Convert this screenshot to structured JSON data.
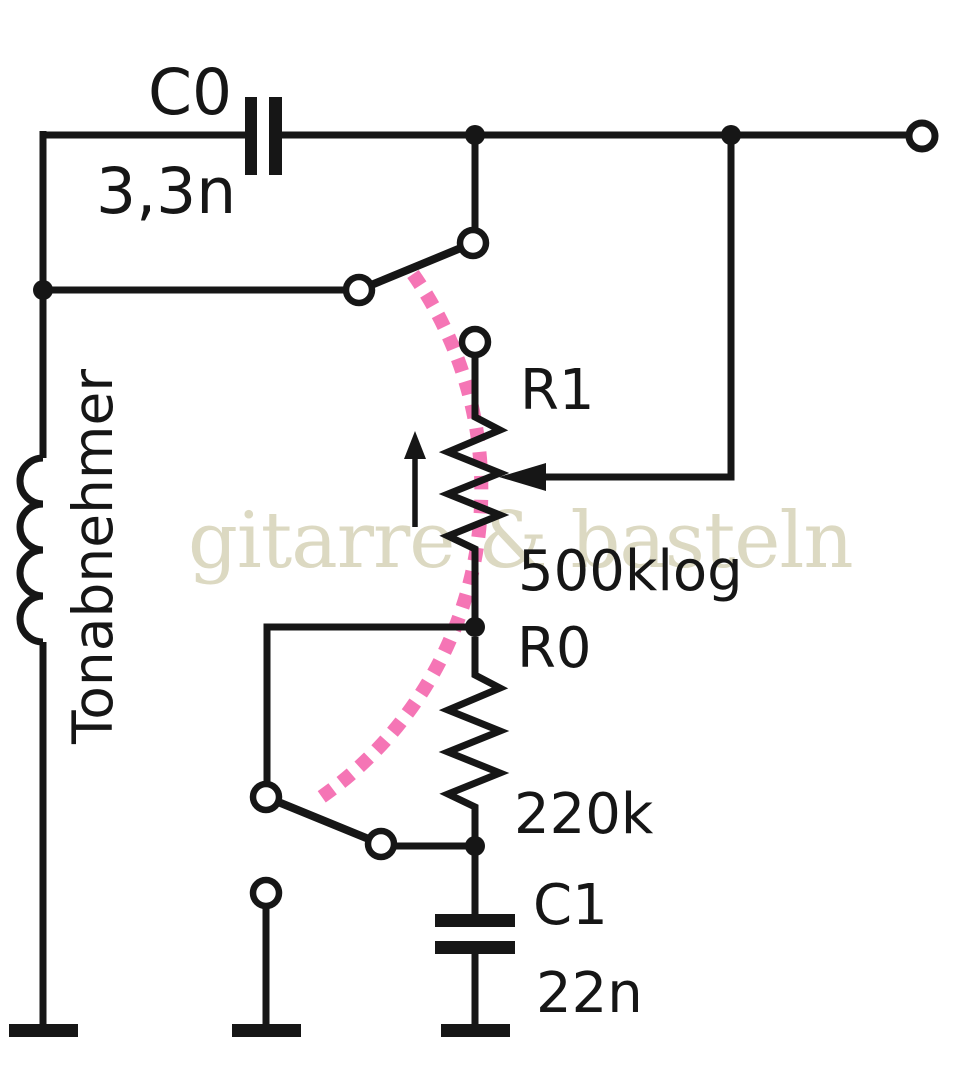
{
  "schematic": {
    "watermark": "gitarre & basteln",
    "pickup_label": "Tonabnehmer",
    "components": {
      "c0": {
        "ref": "C0",
        "value": "3,3n"
      },
      "r1": {
        "ref": "R1",
        "value": "500klog"
      },
      "r0": {
        "ref": "R0",
        "value": "220k"
      },
      "c1": {
        "ref": "C1",
        "value": "22n"
      }
    },
    "colors": {
      "ink": "#161616",
      "switch_arc_pink": "#f575b5",
      "watermark_beige": "#dcd9c2",
      "background": "#ffffff"
    }
  }
}
